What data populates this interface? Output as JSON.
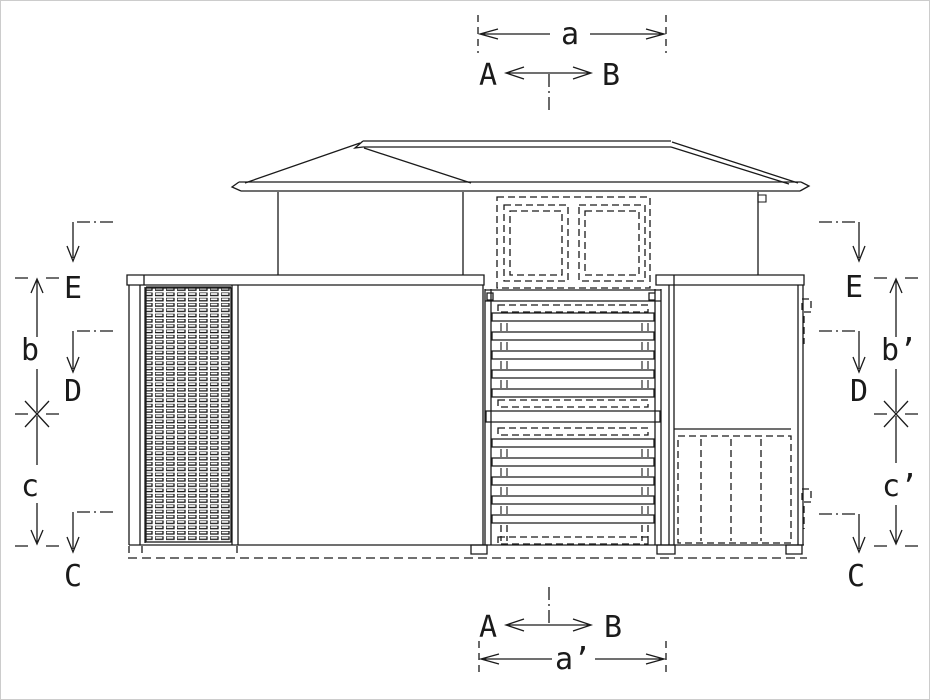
{
  "colors": {
    "line": "#1a1a1a",
    "background": "#ffffff"
  },
  "dimensions": {
    "top": {
      "label": "a"
    },
    "bottom": {
      "label": "a’"
    },
    "left": {
      "upper": "b",
      "lower": "c"
    },
    "right": {
      "upper": "b’",
      "lower": "c’"
    }
  },
  "section_markers": {
    "top": {
      "left": "A",
      "right": "B"
    },
    "bottom": {
      "left": "A",
      "right": "B"
    },
    "left": {
      "top": "E",
      "middle": "D",
      "bottom": "C"
    },
    "right": {
      "top": "E",
      "middle": "D",
      "bottom": "C"
    }
  }
}
